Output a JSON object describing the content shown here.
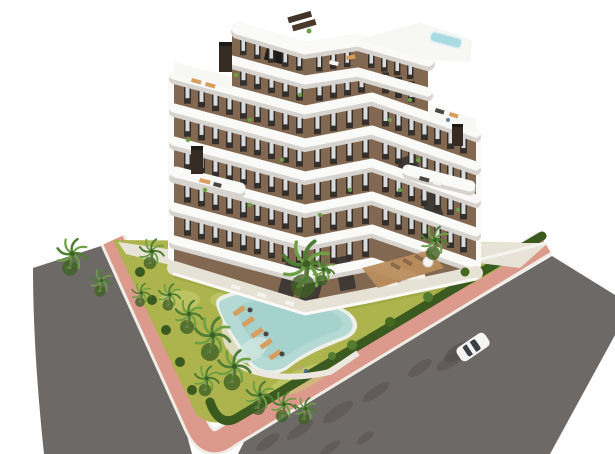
{
  "scene": {
    "type": "architectural-rendering",
    "description": "Aerial 3D render of a modern apartment complex: white curved balcony bands over a brown facade, rooftop terraces with a small roof pool, a landscaped corner plot with lawn, free-form swimming pool, sun loungers and palm trees, wrapped by a pink paver sidewalk and grey asphalt roads with one white car.",
    "building": {
      "name": "apartment-building",
      "floors_visible": 7,
      "style": "curved white balcony slabs, brown facade, dark vertical windows",
      "roof_features": [
        "roof-pool",
        "pergola-panels",
        "chimneys",
        "roof-terraces"
      ]
    },
    "garden": {
      "name": "landscaped-garden",
      "features": [
        "lawn",
        "free-form-pool",
        "sun-loungers",
        "palm-trees",
        "perimeter-hedge",
        "pebble-island",
        "wood-deck"
      ]
    },
    "roads": {
      "left_road": "asphalt",
      "right_road": "asphalt",
      "sidewalk": "pink paver band with white curbs"
    },
    "vehicles": [
      {
        "name": "white-car",
        "color": "white",
        "location": "right road"
      }
    ]
  },
  "palette": {
    "background": "#ffffff",
    "facade": "#826850",
    "facade_dark": "#6a513d",
    "band_white": "#fafaf8",
    "band_shadow": "#d7d4cf",
    "roof_white": "#f7f7f4",
    "window_frame": "#342f2a",
    "window_glass": "#eceef0",
    "chimney": "#362b22",
    "roof_pool": "#a9dbe3",
    "lawn": "#adb44d",
    "lawn_light": "#c9cf75",
    "hedge": "#3b5a1f",
    "palm_leaf": "#4f7d33",
    "palm_leaf_light": "#6da045",
    "palm_trunk": "#99886a",
    "pool_water": "#b5dad6",
    "pool_water_deep": "#a3cfcb",
    "pool_beach": "#cfe4de",
    "pool_rim": "#edf1ea",
    "deck_wood": "#bb8d5e",
    "terrace_beige": "#e7e2d6",
    "path_beige": "#e8e3d7",
    "lounger": "#d79e5f",
    "sidewalk": "#dc9a8c",
    "curb": "#f0ede6",
    "road": "#6d6967",
    "road_shadow": "#5a5653",
    "car_body": "#f5f5f3",
    "car_glass": "#3c4046",
    "car_shadow": "#504c4a",
    "furniture_white": "#f6f4ef",
    "furniture_dark": "#4a4540",
    "dark_recess": "#3f3a36"
  }
}
